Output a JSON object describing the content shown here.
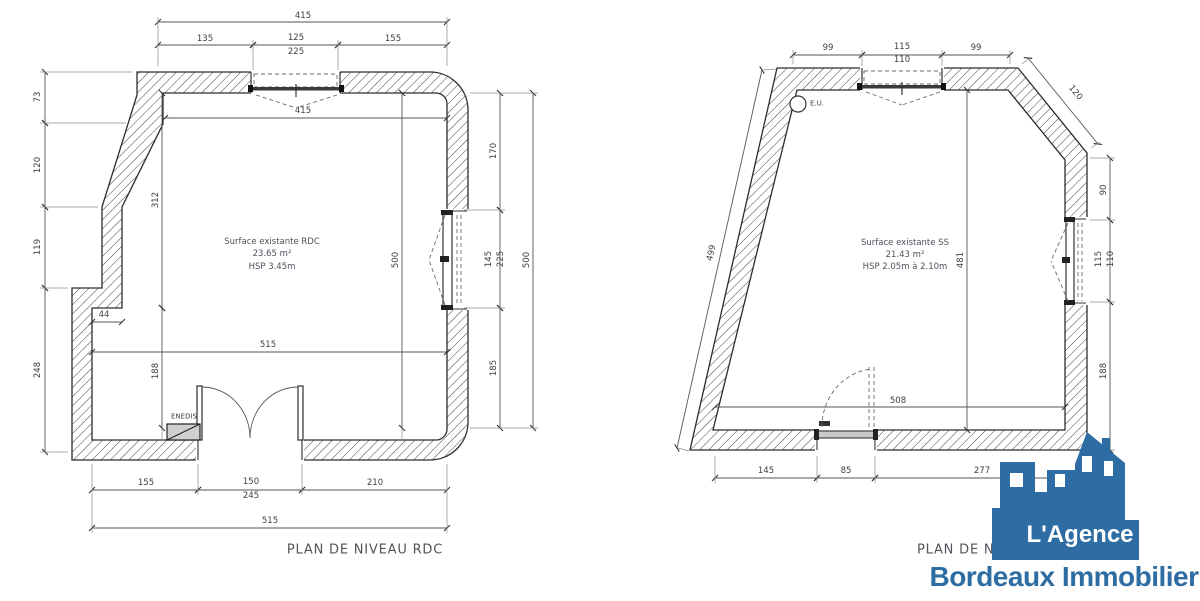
{
  "left_plan": {
    "title": "PLAN DE NIVEAU RDC",
    "room": {
      "line1": "Surface existante RDC",
      "line2": "23.65 m²",
      "line3": "HSP 3.45m"
    },
    "enedis_label": "ENEDIS",
    "dims": {
      "top_total": "415",
      "top_a": "135",
      "top_b": "125",
      "top_b_sub": "225",
      "top_c": "155",
      "inner_top": "415",
      "left_a": "73",
      "left_b": "120",
      "left_c": "119",
      "left_d": "248",
      "inner_left_upper": "312",
      "inner_left_lower": "188",
      "step": "44",
      "inner_width": "515",
      "inner_height": "500",
      "right_a": "170",
      "right_b": "145",
      "right_b_sub": "225",
      "right_c": "185",
      "right_total": "500",
      "bottom_a": "155",
      "bottom_b": "150",
      "bottom_b_sub": "245",
      "bottom_c": "210",
      "bottom_total": "515"
    }
  },
  "right_plan": {
    "title": "PLAN DE NIVEAU SOUS-SOL",
    "room": {
      "line1": "Surface existante SS",
      "line2": "21.43 m²",
      "line3": "HSP 2.05m à 2.10m"
    },
    "eu_label": "E.U.",
    "dims": {
      "top_a": "99",
      "top_b": "115",
      "top_b_sub": "110",
      "top_c": "99",
      "chamfer": "120",
      "slant": "499",
      "right_a": "90",
      "right_b": "115",
      "right_b_sub": "110",
      "right_c": "188",
      "inner_height": "481",
      "inner_width": "508",
      "bottom_a": "145",
      "bottom_b": "85",
      "bottom_c": "277"
    }
  },
  "logo": {
    "line1": "L'Agence",
    "line2": "Bordeaux Immobilier",
    "blue": "#2e6da4"
  }
}
